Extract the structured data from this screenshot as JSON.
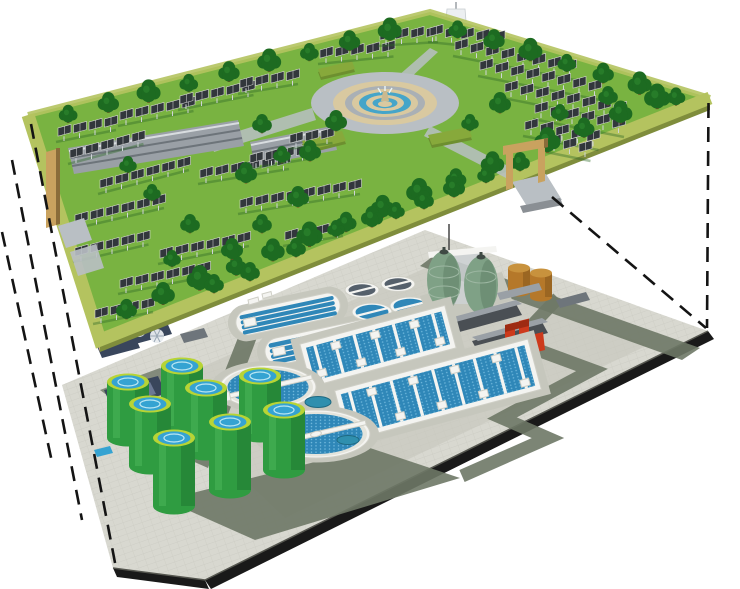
{
  "scene": {
    "description": "cutaway-rendering-of-underground-wastewater-treatment-plant-beneath-surface-solar-park",
    "upper_level": {
      "label": "surface-solar-park",
      "components": [
        "solar-panel-arrays",
        "tree-rows",
        "lawn",
        "central-fountain-plaza",
        "observation-tower",
        "greenhouse-buildings",
        "entrance-gate",
        "side-gate",
        "perimeter-edge-band"
      ],
      "counts": {
        "solar_rows": 25
      }
    },
    "lower_level": {
      "label": "underground-treatment-plant",
      "components": [
        "green-storage-tanks",
        "circular-clarifiers",
        "small-clarifiers",
        "oxidation-ditches",
        "aeration-basins",
        "egg-digesters",
        "fuel-tanks",
        "service-buildings",
        "red-pump-station",
        "blower-unit",
        "service-roads",
        "tiled-deck"
      ],
      "counts": {
        "green_storage_tanks": 8,
        "circular_clarifiers": 2,
        "small_clarifiers": 4,
        "oxidation_ditches": 2,
        "aeration_basins": 2,
        "egg_digesters": 2,
        "fuel_tanks": 2
      }
    },
    "projection_lines": {
      "left_count": 3,
      "right_count": 2,
      "style": "dashed"
    }
  },
  "palette": {
    "bg": "#ffffff",
    "line": "#141414",
    "grass": "#79b341",
    "tree": "#1d6b21",
    "tree_light": "#2f8b31",
    "trunk": "#7a4f24",
    "platform_band": "#b4c35f",
    "platform_side": "#7f8d3c",
    "platform_side_left": "#c2a772",
    "panel": "#32373c",
    "panel_line": "#dedede",
    "post": "#cfd4d8",
    "shadowline": "#2f6a28",
    "plaza_road": "#b9bfc4",
    "plaza_tan": "#d9c9a0",
    "plaza_gray": "#aab0b5",
    "fountain_blue": "#45a5c9",
    "tower_white": "#eceff1",
    "gate_tan": "#c9a25f",
    "gate_dark": "#8a6c3a",
    "hedge": "#6d8f2f",
    "hedge_top": "#87a93b",
    "deck": "#d8d8d0",
    "deck_dark": "#c6c7bd",
    "road": "#6e7866",
    "edge_black": "#191919",
    "white": "#f4f4f1",
    "wall_shade": "#e4e4dc",
    "clarifier_blue": "#2f87b8",
    "tank_green": "#2f9c41",
    "tank_green_light": "#4ab457",
    "tank_green_dark": "#1e7330",
    "tank_rim": "#b8d435",
    "tank_water": "#35a3d2",
    "egg": "#7fa186",
    "egg_dark": "#55755c",
    "brown": "#b5782a",
    "brown_dark": "#8a5a1e",
    "brown_top": "#c8923d",
    "red": "#cd3a1c",
    "red_dark": "#9e2b12",
    "building": "#4a4f54",
    "building_light": "#9aa0a6",
    "building_mid": "#6e757b",
    "steel": "#39465c",
    "steel_light": "#6b7894"
  }
}
